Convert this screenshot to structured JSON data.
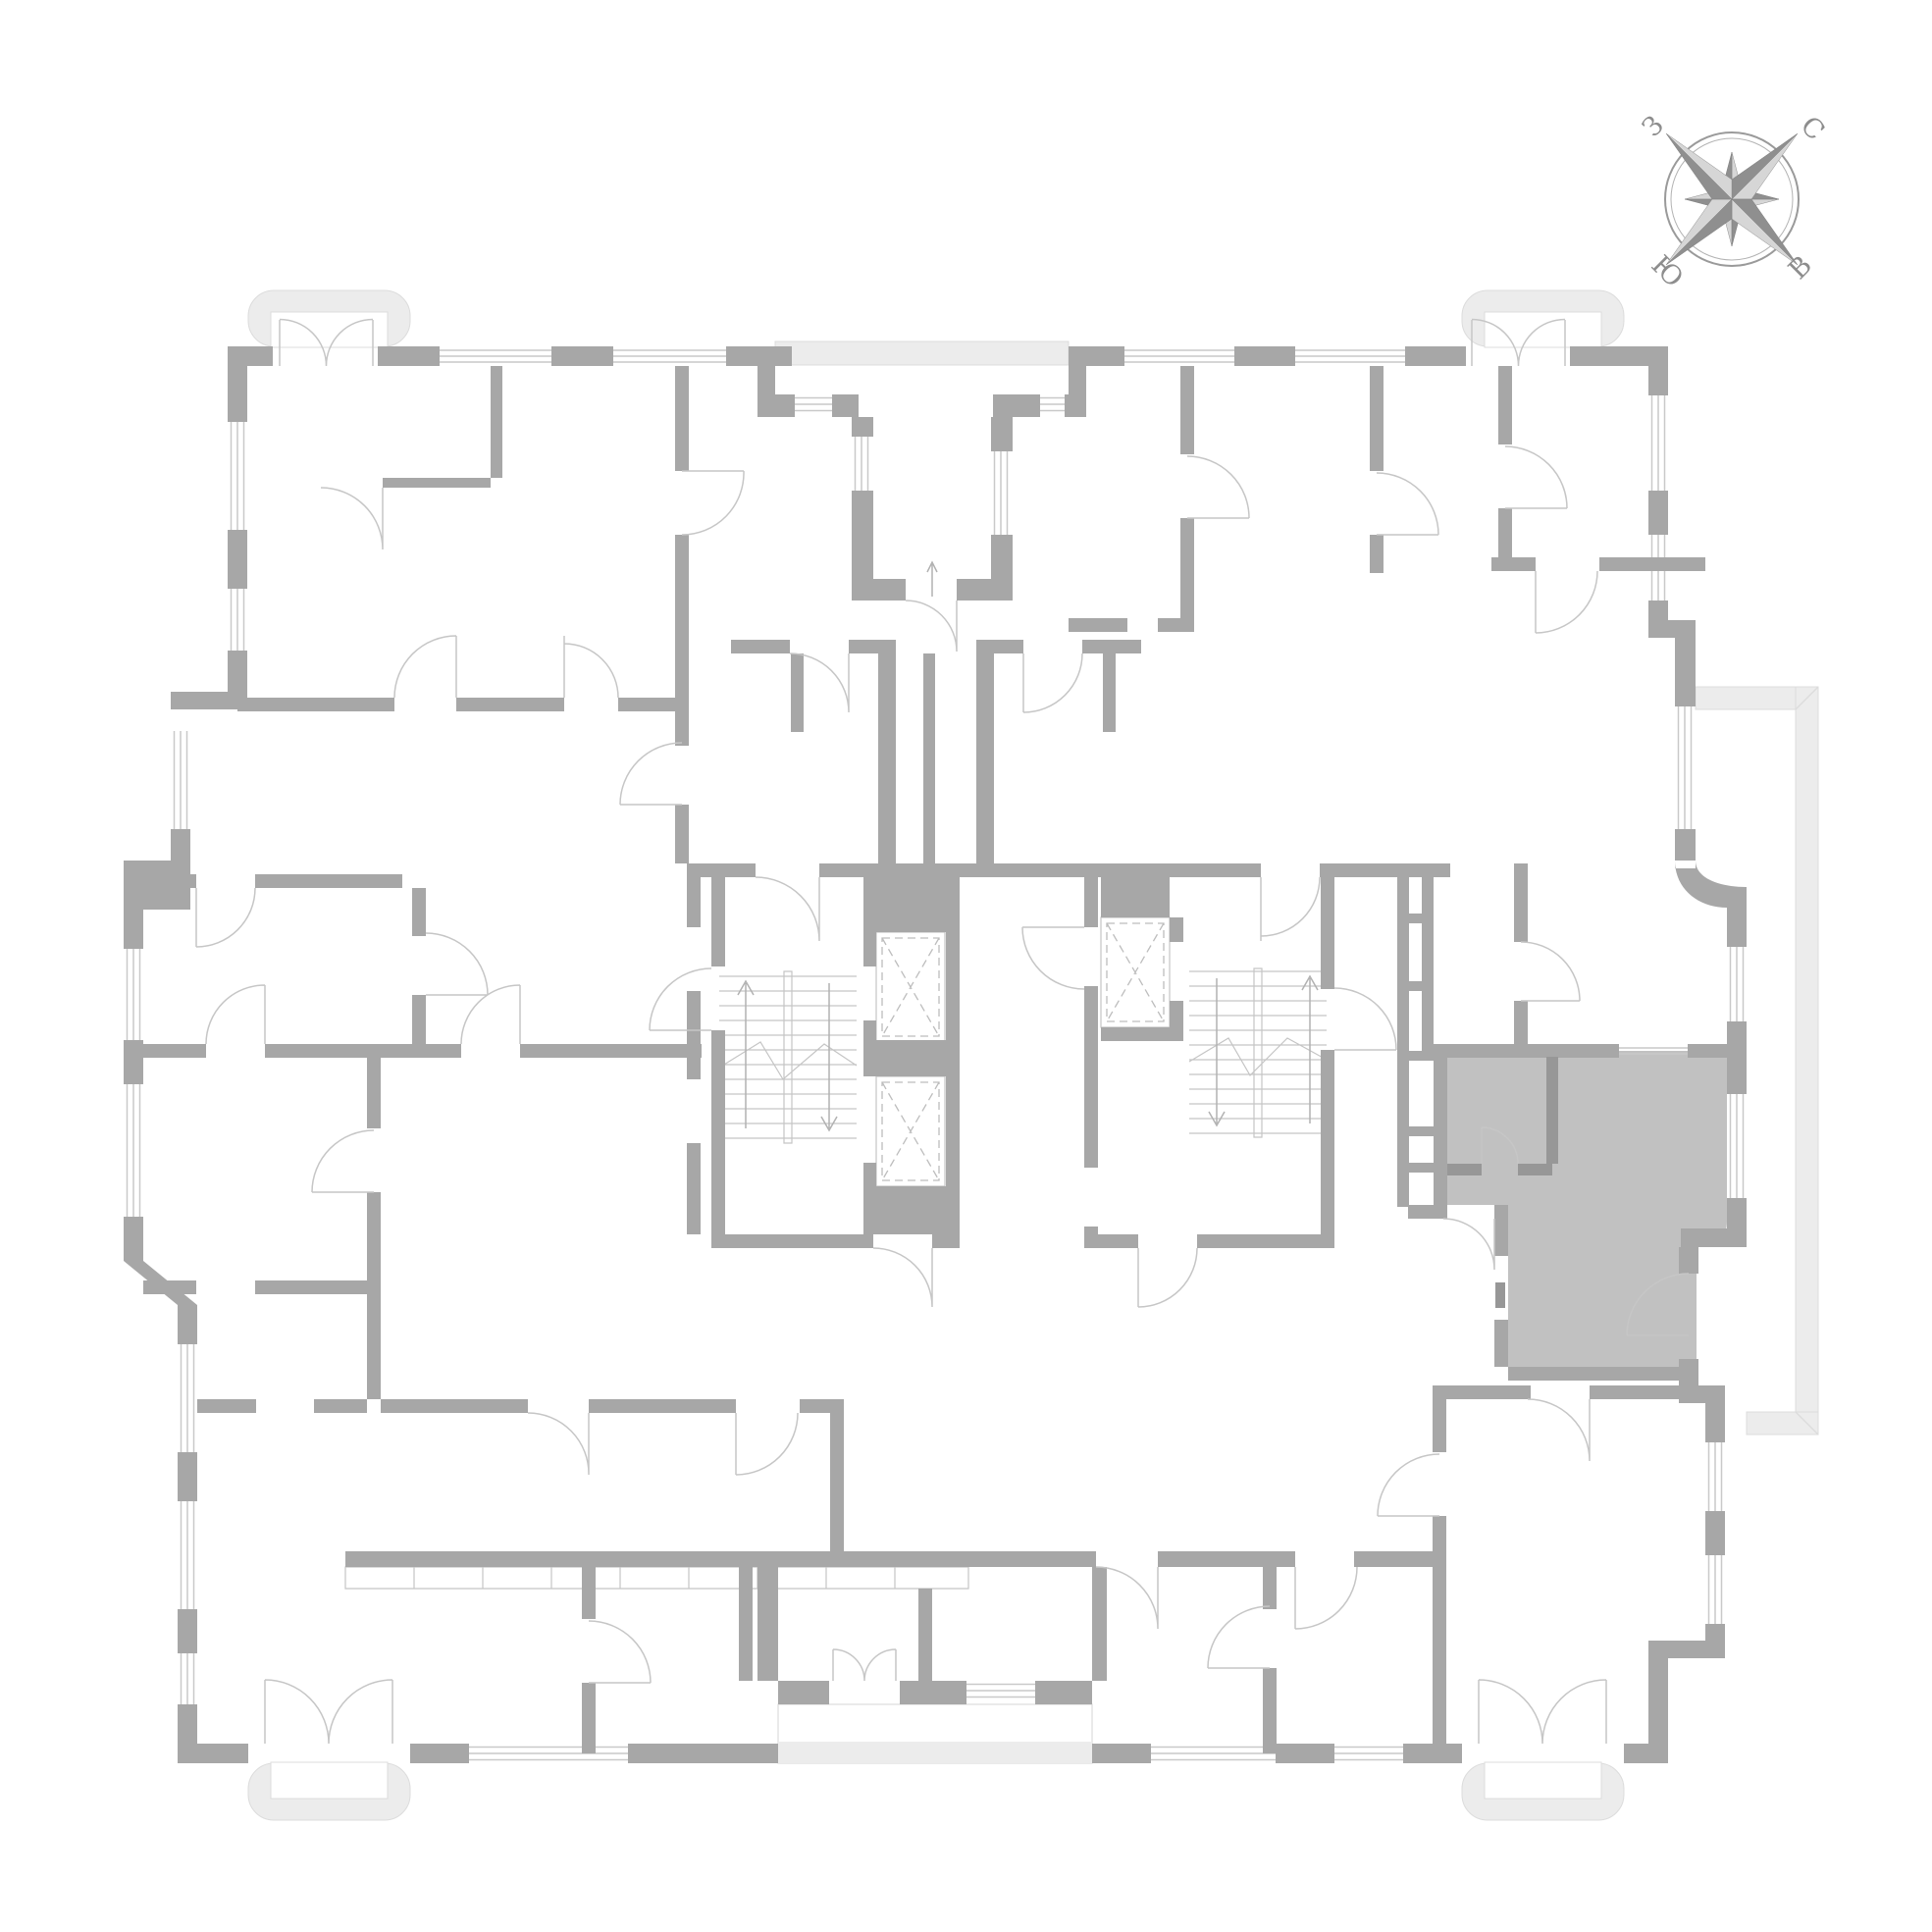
{
  "compass": {
    "north": "С",
    "east": "В",
    "south": "Ю",
    "west": "З"
  },
  "colors": {
    "wall": "#a7a7a7",
    "walldark": "#979797",
    "highlight": "#c1c1c1",
    "glaze": "#c9c9c9",
    "thin": "#c5c5c5",
    "balcfill": "#ececec",
    "balcedge": "#dcdcdc",
    "door": "#c6c6c6",
    "arrow": "#b2b2b2",
    "compdark": "#8f8f8f",
    "complight": "#d6d6d6",
    "comptext": "#8d8d8d"
  }
}
